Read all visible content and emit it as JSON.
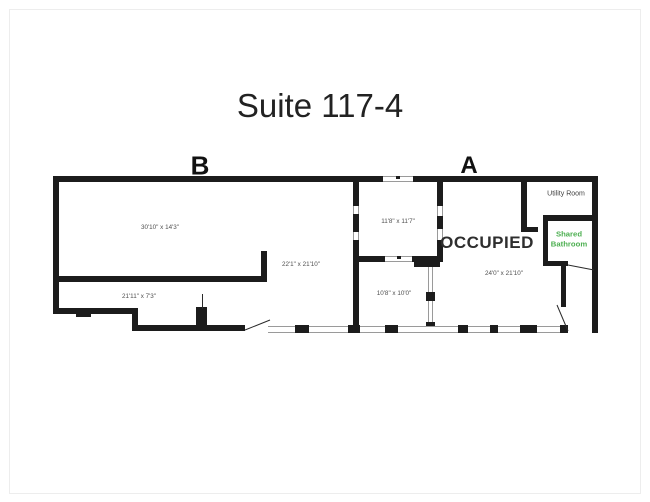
{
  "title": "Suite 117-4",
  "sections": {
    "b": "B",
    "a": "A"
  },
  "rooms": {
    "b_main": {
      "dim": "30'10\" x 14'3\""
    },
    "b_lower": {
      "dim": "21'11\" x 7'3\""
    },
    "open_area": {
      "dim": "22'1\" x 21'10\""
    },
    "small_upper": {
      "dim": "11'8\" x 11'7\""
    },
    "small_lower": {
      "dim": "10'8\" x 10'0\""
    },
    "occupied": {
      "label": "OCCUPIED",
      "dim": "24'0\" x 21'10\""
    },
    "utility": {
      "name": "Utility Room"
    },
    "bathroom": {
      "name": "Shared Bathroom"
    }
  },
  "colors": {
    "wall": "#1c1c1c",
    "dimension_text": "#4f4f4f",
    "occupied_text": "#2e2e2e",
    "bathroom_text": "#4caf50",
    "utility_text": "#3f3f3f"
  }
}
